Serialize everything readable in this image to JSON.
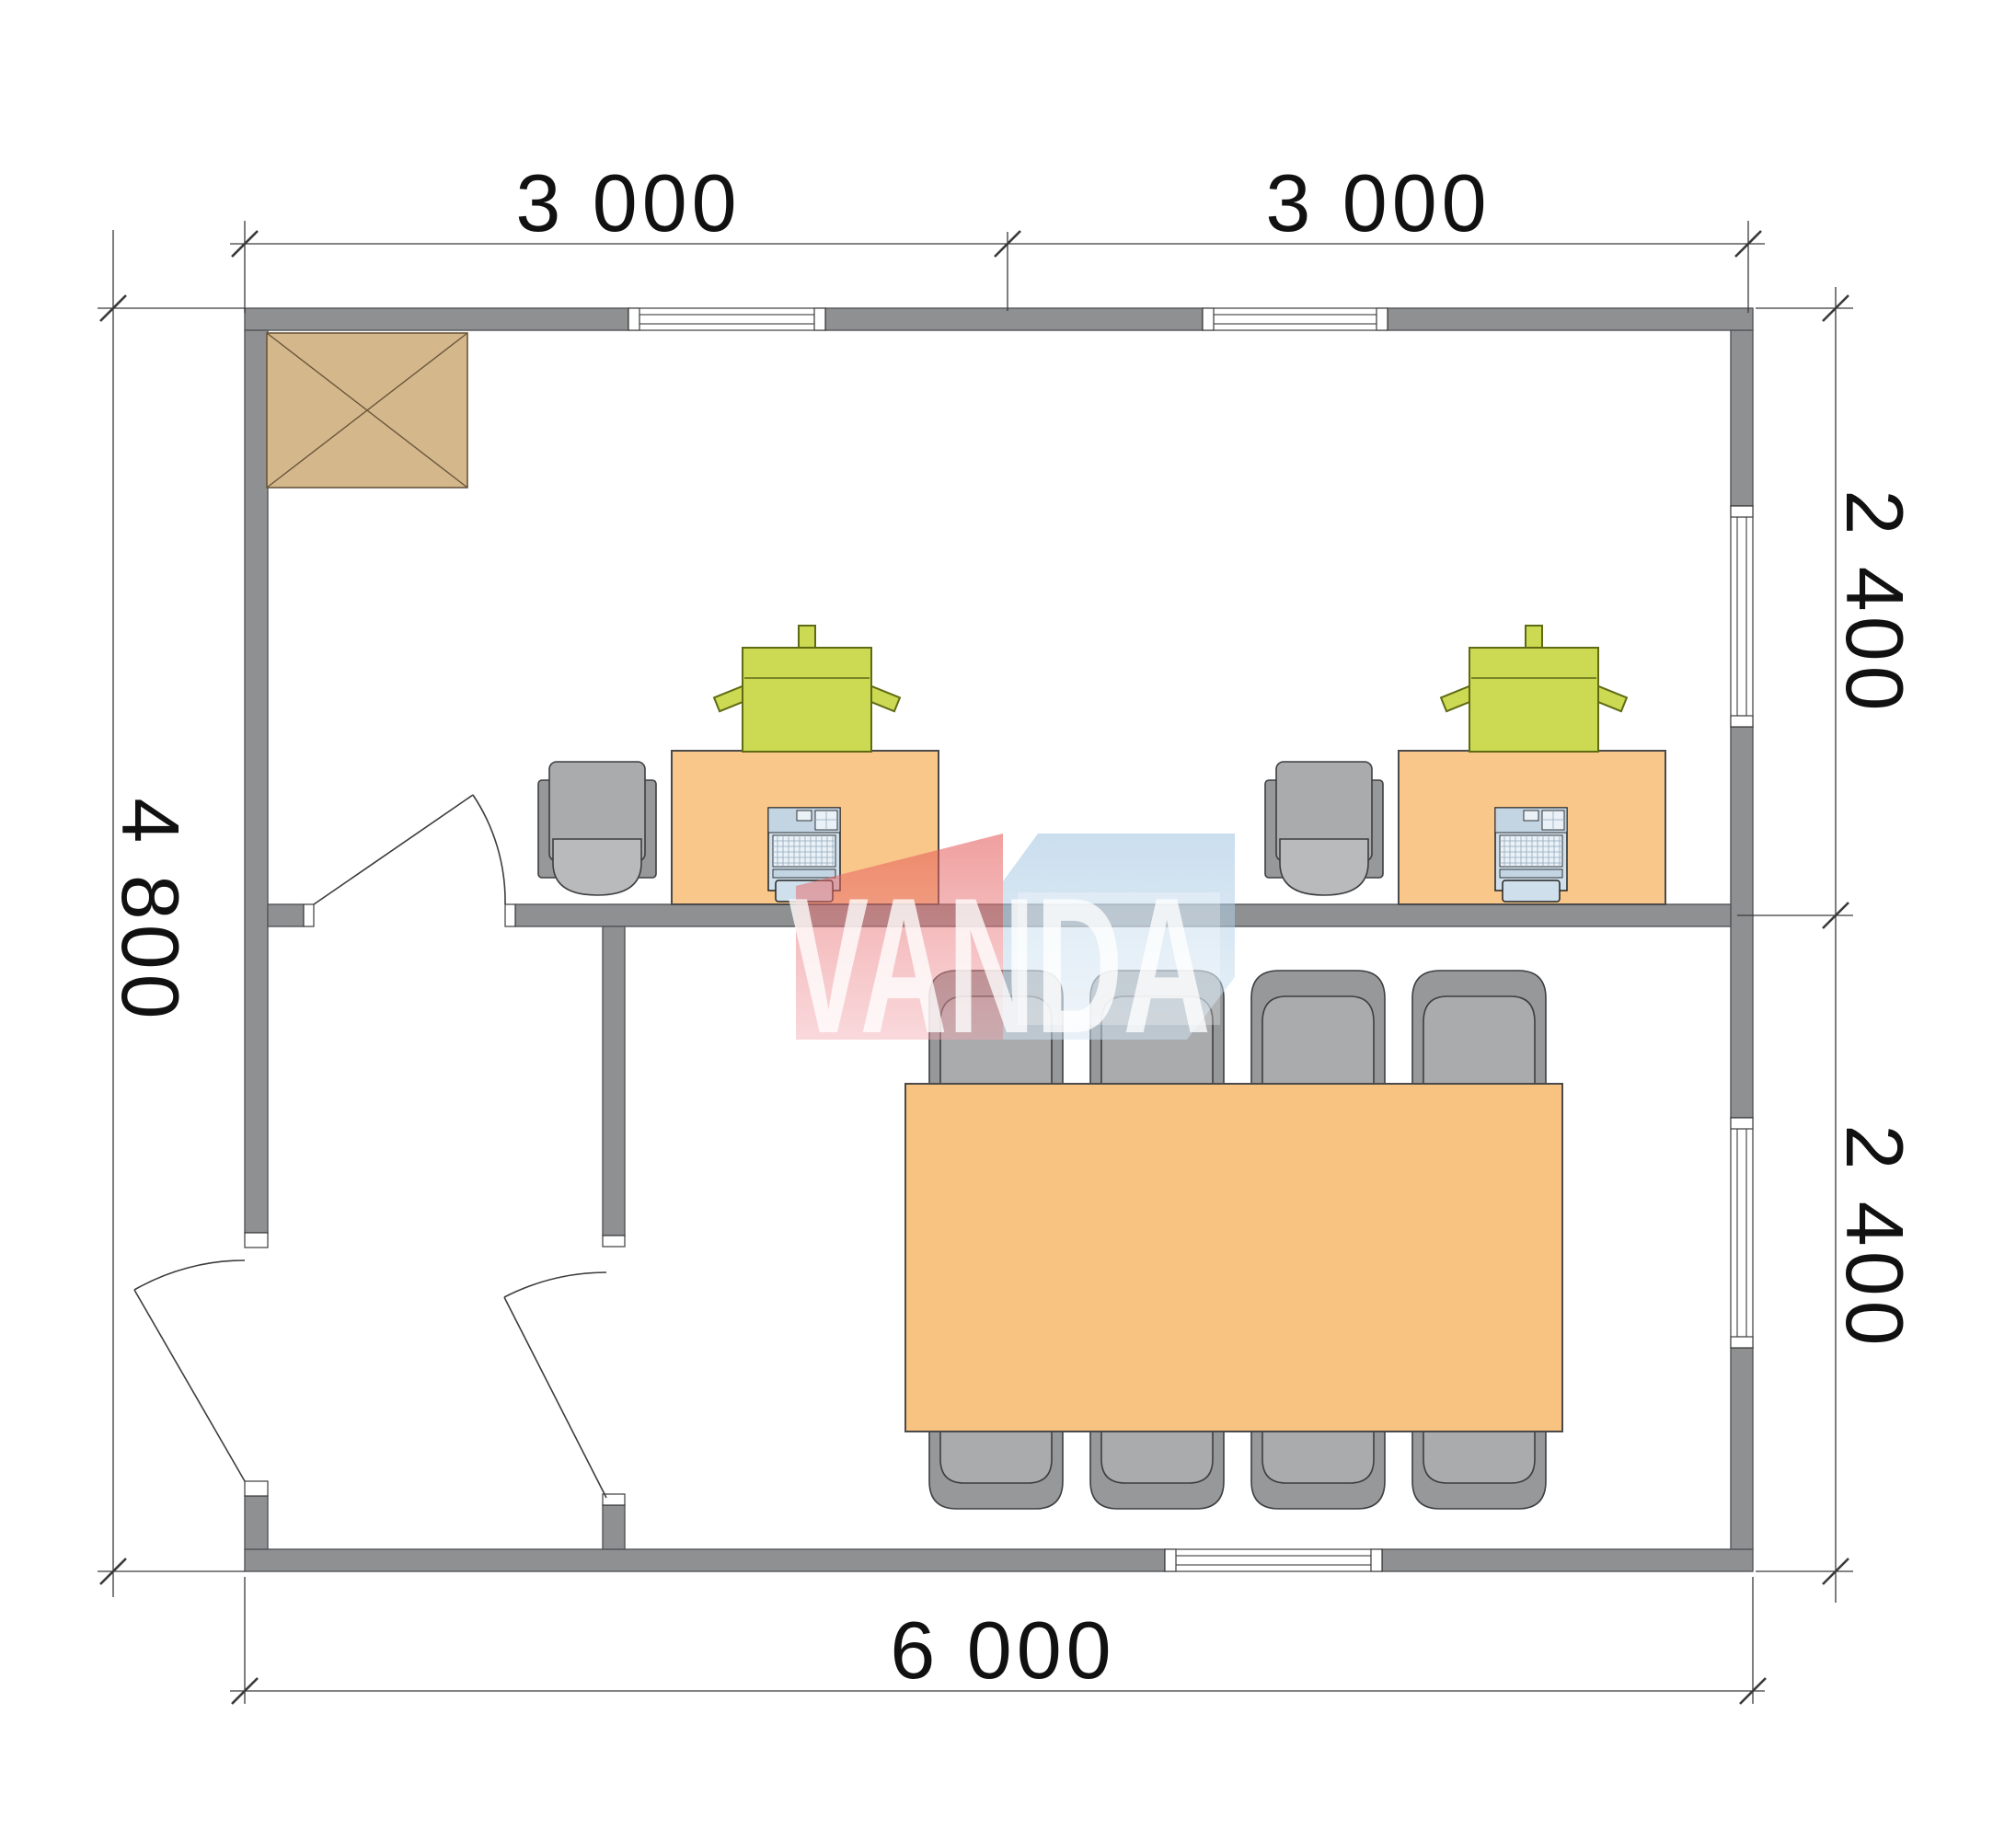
{
  "document": {
    "type": "floor-plan",
    "units": "mm"
  },
  "watermark": {
    "text": "VANDA"
  },
  "dimensions": {
    "top": [
      "3 000",
      "3 000"
    ],
    "left": [
      "4 800"
    ],
    "right": [
      "2 400",
      "2 400"
    ],
    "bottom": [
      "6 000"
    ]
  },
  "plan": {
    "overall_width_mm": 6000,
    "overall_depth_mm": 4800,
    "modules": [
      {
        "width_mm": 3000,
        "depth_mm": 2400
      },
      {
        "width_mm": 3000,
        "depth_mm": 2400
      }
    ],
    "rooms": [
      {
        "name": "office-room",
        "furniture": {
          "workstations": 2,
          "desks": 2,
          "office_chairs": 2,
          "printers": 2,
          "laptops": 2,
          "cabinet": 1
        }
      },
      {
        "name": "meeting-room",
        "furniture": {
          "table": 1,
          "chairs": 8
        }
      },
      {
        "name": "entrance-hall",
        "furniture": {}
      }
    ],
    "openings": {
      "doors": 3,
      "windows": 5
    }
  },
  "colors": {
    "wall": "#8e9092",
    "wallEdge": "#55565a",
    "lineColor": "#3a3a3a",
    "dimText": "#111111",
    "cabinetFill": "#d4b88c",
    "cabinetEdge": "#6b563a",
    "deskFill": "#f9c78a",
    "tableFill": "#f8c280",
    "furnEdge": "#4a4a4a",
    "printerFill": "#ccd952",
    "printerEdge": "#5f6b14",
    "chairDark": "#96989a",
    "chairMid": "#a9abad",
    "chairLight": "#b8babc",
    "chairEdge": "#3c3e40",
    "laptopBody": "#cfe0ec",
    "laptopBand": "#c3d4e2",
    "laptopKeys": "#eaf1f7",
    "laptopEdge": "#222222",
    "wmRed": "#e3514f",
    "wmRedLight": "#f2a9b0",
    "wmBlue": "#9fc3e0",
    "wmBlueLight": "#d2e4f2",
    "wmText": "#ffffff"
  }
}
